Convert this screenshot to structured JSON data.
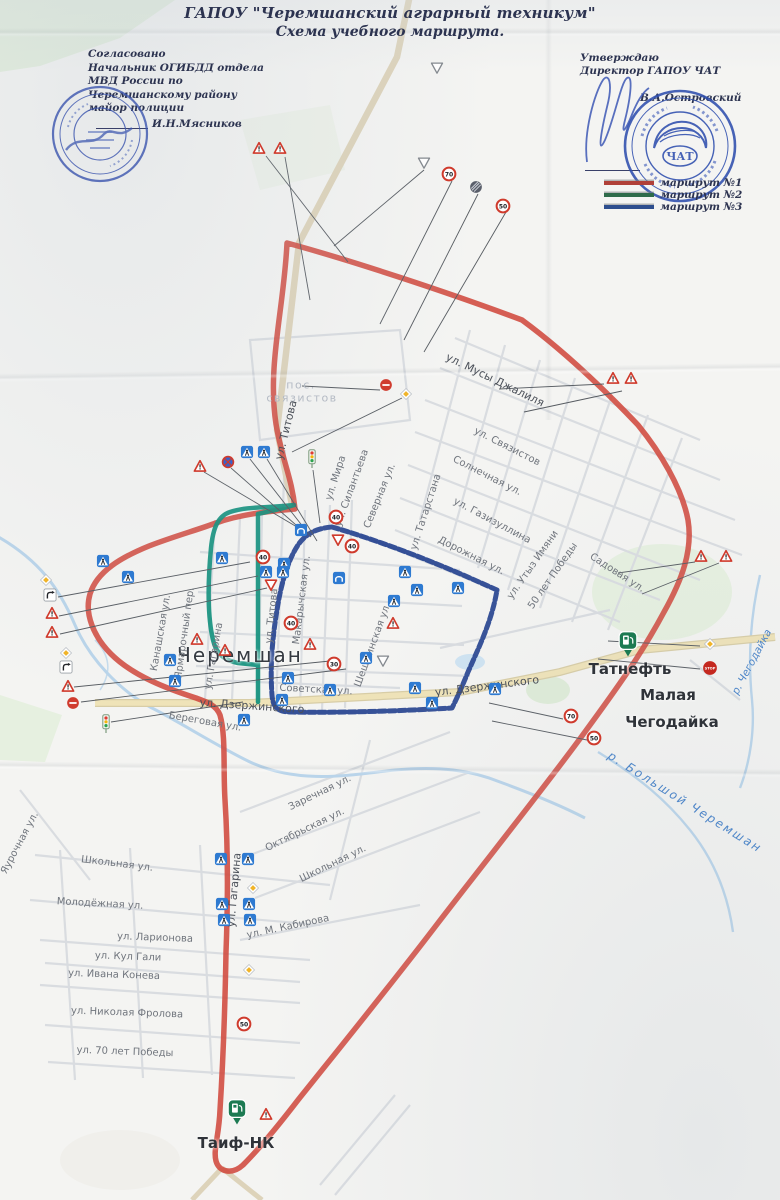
{
  "header": {
    "title_line1": "ГАПОУ \"Черемшанский аграрный техникум\"",
    "title_line2": "Схема учебного маршрута."
  },
  "approval_left": {
    "lines": "Согласовано\nНачальник ОГИБДД отдела\nМВД России по\nЧеремшанскому району\nмайор полиции",
    "name": "И.Н.Мясников"
  },
  "approval_right": {
    "line1": "Утверждаю",
    "line2": "Директор ГАПОУ ЧАТ",
    "name": "В.А.Островский",
    "stamp_center": "ЧАТ"
  },
  "legend": {
    "items": [
      {
        "label": "маршрут №1",
        "color": "#b04038"
      },
      {
        "label": "маршрут №2",
        "color": "#2e6b4a"
      },
      {
        "label": "маршрут №3",
        "color": "#2d4e8e"
      }
    ]
  },
  "map": {
    "route_colors": {
      "r1": "#d0493e",
      "r2": "#12917d",
      "r3": "#24418f"
    },
    "labels": [
      {
        "t": "пос.",
        "x": 301,
        "y": 385,
        "r": 0,
        "c": "l-lt"
      },
      {
        "t": "связистов",
        "x": 302,
        "y": 398,
        "r": 0,
        "c": "l-lt"
      },
      {
        "t": "ул. Мусы Джалиля",
        "x": 495,
        "y": 380,
        "r": 26,
        "c": "l-std"
      },
      {
        "t": "ул. Связистов",
        "x": 507,
        "y": 447,
        "r": 27,
        "c": "l-st"
      },
      {
        "t": "Солнечная ул.",
        "x": 487,
        "y": 476,
        "r": 27,
        "c": "l-st"
      },
      {
        "t": "ул. Мира",
        "x": 336,
        "y": 478,
        "r": -72,
        "c": "l-st"
      },
      {
        "t": "ул. Силантьева",
        "x": 352,
        "y": 488,
        "r": -70,
        "c": "l-st"
      },
      {
        "t": "Северная ул.",
        "x": 380,
        "y": 496,
        "r": -68,
        "c": "l-st"
      },
      {
        "t": "ул. Татарстана",
        "x": 426,
        "y": 512,
        "r": -72,
        "c": "l-st"
      },
      {
        "t": "ул. Газизуллина",
        "x": 492,
        "y": 521,
        "r": 28,
        "c": "l-st"
      },
      {
        "t": "Дорожная ул.",
        "x": 471,
        "y": 556,
        "r": 27,
        "c": "l-st"
      },
      {
        "t": "ул. Утыз Имяни",
        "x": 533,
        "y": 565,
        "r": -55,
        "c": "l-st"
      },
      {
        "t": "50 лет Победы",
        "x": 553,
        "y": 576,
        "r": -55,
        "c": "l-st"
      },
      {
        "t": "Садовая ул.",
        "x": 617,
        "y": 573,
        "r": 33,
        "c": "l-st"
      },
      {
        "t": "ул. Титова",
        "x": 286,
        "y": 430,
        "r": -76,
        "c": "l-std"
      },
      {
        "t": "ул. Титова",
        "x": 272,
        "y": 616,
        "r": -84,
        "c": "l-st"
      },
      {
        "t": "Черемшан",
        "x": 240,
        "y": 655,
        "r": 0,
        "c": "l-big"
      },
      {
        "t": "Советская ул.",
        "x": 316,
        "y": 690,
        "r": 3,
        "c": "l-st"
      },
      {
        "t": "ул. Дзержинского",
        "x": 252,
        "y": 706,
        "r": 4,
        "c": "l-std"
      },
      {
        "t": "ул. Дзержинского",
        "x": 487,
        "y": 686,
        "r": -7,
        "c": "l-std"
      },
      {
        "t": "Канашская ул.",
        "x": 161,
        "y": 633,
        "r": -80,
        "c": "l-st"
      },
      {
        "t": "Ярмарочный пер.",
        "x": 185,
        "y": 633,
        "r": -82,
        "c": "l-st"
      },
      {
        "t": "ул. Гагарина",
        "x": 214,
        "y": 656,
        "r": -80,
        "c": "l-st"
      },
      {
        "t": "Макарычская ул.",
        "x": 302,
        "y": 600,
        "r": -83,
        "c": "l-st"
      },
      {
        "t": "Шешминская ул.",
        "x": 373,
        "y": 645,
        "r": -70,
        "c": "l-st"
      },
      {
        "t": "Береговая ул.",
        "x": 205,
        "y": 722,
        "r": 10,
        "c": "l-st"
      },
      {
        "t": "Заречная ул.",
        "x": 320,
        "y": 793,
        "r": -26,
        "c": "l-st"
      },
      {
        "t": "Октябрьская ул.",
        "x": 305,
        "y": 830,
        "r": -26,
        "c": "l-st"
      },
      {
        "t": "Школьная ул.",
        "x": 333,
        "y": 864,
        "r": -26,
        "c": "l-st"
      },
      {
        "t": "Школьная ул.",
        "x": 117,
        "y": 864,
        "r": 7,
        "c": "l-st"
      },
      {
        "t": "Молодёжная ул.",
        "x": 100,
        "y": 904,
        "r": 3,
        "c": "l-st"
      },
      {
        "t": "ул. Ларионова",
        "x": 155,
        "y": 938,
        "r": 2,
        "c": "l-st"
      },
      {
        "t": "ул. Кул Гали",
        "x": 128,
        "y": 957,
        "r": 2,
        "c": "l-st"
      },
      {
        "t": "ул. Ивана Конева",
        "x": 114,
        "y": 975,
        "r": 2,
        "c": "l-st"
      },
      {
        "t": "ул. Николая Фролова",
        "x": 127,
        "y": 1013,
        "r": 2,
        "c": "l-st"
      },
      {
        "t": "ул. 70 лет Победы",
        "x": 125,
        "y": 1052,
        "r": 2,
        "c": "l-st"
      },
      {
        "t": "ул. М. Кабирова",
        "x": 288,
        "y": 927,
        "r": -12,
        "c": "l-st"
      },
      {
        "t": "ул. Гагарина",
        "x": 234,
        "y": 890,
        "r": -85,
        "c": "l-std"
      },
      {
        "t": "Яурочная ул.",
        "x": 20,
        "y": 843,
        "r": -62,
        "c": "l-st"
      },
      {
        "t": "Малая",
        "x": 668,
        "y": 695,
        "r": 0,
        "c": "l-town"
      },
      {
        "t": "Чегодайка",
        "x": 672,
        "y": 722,
        "r": 0,
        "c": "l-town"
      },
      {
        "t": "Татнефть",
        "x": 630,
        "y": 669,
        "r": 0,
        "c": "l-town"
      },
      {
        "t": "Таиф-НК",
        "x": 236,
        "y": 1143,
        "r": 0,
        "c": "l-town"
      },
      {
        "t": "р. Чегодайка",
        "x": 752,
        "y": 662,
        "r": -62,
        "c": "l-rv"
      },
      {
        "t": "р. Большой Черемшан",
        "x": 685,
        "y": 802,
        "r": 32,
        "c": "l-rvb"
      }
    ],
    "signs": [
      {
        "t": "warn",
        "x": 259,
        "y": 148
      },
      {
        "t": "warn",
        "x": 280,
        "y": 148
      },
      {
        "t": "giveo",
        "x": 437,
        "y": 68
      },
      {
        "t": "giveo",
        "x": 424,
        "y": 163
      },
      {
        "t": "spd",
        "x": 449,
        "y": 174,
        "v": "70"
      },
      {
        "t": "end",
        "x": 476,
        "y": 187
      },
      {
        "t": "spd",
        "x": 503,
        "y": 206,
        "v": "50"
      },
      {
        "t": "ne",
        "x": 386,
        "y": 385
      },
      {
        "t": "dia",
        "x": 406,
        "y": 394
      },
      {
        "t": "warn",
        "x": 613,
        "y": 378
      },
      {
        "t": "warn",
        "x": 631,
        "y": 378
      },
      {
        "t": "warn",
        "x": 701,
        "y": 556
      },
      {
        "t": "warn",
        "x": 726,
        "y": 556
      },
      {
        "t": "spd",
        "x": 571,
        "y": 716,
        "v": "70"
      },
      {
        "t": "spd",
        "x": 594,
        "y": 738,
        "v": "50"
      },
      {
        "t": "dia",
        "x": 710,
        "y": 644
      },
      {
        "t": "stop",
        "x": 710,
        "y": 668
      },
      {
        "t": "gas",
        "x": 628,
        "y": 644
      },
      {
        "t": "dia",
        "x": 46,
        "y": 580
      },
      {
        "t": "crv",
        "x": 50,
        "y": 595
      },
      {
        "t": "warn",
        "x": 52,
        "y": 613
      },
      {
        "t": "warn",
        "x": 52,
        "y": 632
      },
      {
        "t": "dia",
        "x": 66,
        "y": 653
      },
      {
        "t": "crv",
        "x": 66,
        "y": 667
      },
      {
        "t": "warn",
        "x": 68,
        "y": 686
      },
      {
        "t": "ne",
        "x": 73,
        "y": 703
      },
      {
        "t": "tl",
        "x": 106,
        "y": 724
      },
      {
        "t": "warn",
        "x": 200,
        "y": 466
      },
      {
        "t": "nsp",
        "x": 228,
        "y": 462
      },
      {
        "t": "ped",
        "x": 247,
        "y": 452
      },
      {
        "t": "ped",
        "x": 264,
        "y": 452
      },
      {
        "t": "tl",
        "x": 312,
        "y": 459
      },
      {
        "t": "ped",
        "x": 103,
        "y": 561
      },
      {
        "t": "ped",
        "x": 128,
        "y": 577
      },
      {
        "t": "ped",
        "x": 222,
        "y": 558
      },
      {
        "t": "ped",
        "x": 284,
        "y": 564
      },
      {
        "t": "spd",
        "x": 263,
        "y": 557,
        "v": "40"
      },
      {
        "t": "spd",
        "x": 336,
        "y": 517,
        "v": "40"
      },
      {
        "t": "spd",
        "x": 352,
        "y": 546,
        "v": "40"
      },
      {
        "t": "spd",
        "x": 291,
        "y": 623,
        "v": "40"
      },
      {
        "t": "spd",
        "x": 334,
        "y": 664,
        "v": "30"
      },
      {
        "t": "arch",
        "x": 301,
        "y": 530
      },
      {
        "t": "arch",
        "x": 339,
        "y": 578
      },
      {
        "t": "give",
        "x": 338,
        "y": 540
      },
      {
        "t": "give",
        "x": 271,
        "y": 585
      },
      {
        "t": "giveo",
        "x": 383,
        "y": 661
      },
      {
        "t": "ped",
        "x": 266,
        "y": 572
      },
      {
        "t": "ped",
        "x": 283,
        "y": 572
      },
      {
        "t": "ped",
        "x": 405,
        "y": 572
      },
      {
        "t": "ped",
        "x": 417,
        "y": 590
      },
      {
        "t": "ped",
        "x": 394,
        "y": 601
      },
      {
        "t": "ped",
        "x": 458,
        "y": 588
      },
      {
        "t": "warn",
        "x": 197,
        "y": 639
      },
      {
        "t": "warn",
        "x": 225,
        "y": 650
      },
      {
        "t": "warn",
        "x": 310,
        "y": 644
      },
      {
        "t": "warn",
        "x": 393,
        "y": 623
      },
      {
        "t": "ped",
        "x": 170,
        "y": 660
      },
      {
        "t": "ped",
        "x": 175,
        "y": 681
      },
      {
        "t": "ped",
        "x": 366,
        "y": 658
      },
      {
        "t": "ped",
        "x": 244,
        "y": 720
      },
      {
        "t": "ped",
        "x": 282,
        "y": 700
      },
      {
        "t": "ped",
        "x": 288,
        "y": 678
      },
      {
        "t": "ped",
        "x": 330,
        "y": 690
      },
      {
        "t": "ped",
        "x": 415,
        "y": 688
      },
      {
        "t": "ped",
        "x": 432,
        "y": 703
      },
      {
        "t": "ped",
        "x": 495,
        "y": 689
      },
      {
        "t": "ped",
        "x": 221,
        "y": 859
      },
      {
        "t": "ped",
        "x": 248,
        "y": 859
      },
      {
        "t": "ped",
        "x": 222,
        "y": 904
      },
      {
        "t": "ped",
        "x": 249,
        "y": 904
      },
      {
        "t": "ped",
        "x": 224,
        "y": 920
      },
      {
        "t": "ped",
        "x": 250,
        "y": 920
      },
      {
        "t": "dia",
        "x": 253,
        "y": 888
      },
      {
        "t": "dia",
        "x": 249,
        "y": 970
      },
      {
        "t": "spd",
        "x": 244,
        "y": 1024,
        "v": "50"
      },
      {
        "t": "gas",
        "x": 237,
        "y": 1112
      },
      {
        "t": "warn",
        "x": 266,
        "y": 1114
      }
    ],
    "leaders": [
      [
        266,
        156,
        348,
        262
      ],
      [
        285,
        157,
        310,
        300
      ],
      [
        424,
        170,
        334,
        246
      ],
      [
        452,
        181,
        380,
        324
      ],
      [
        478,
        194,
        404,
        340
      ],
      [
        506,
        212,
        424,
        352
      ],
      [
        604,
        384,
        499,
        389
      ],
      [
        622,
        391,
        524,
        412
      ],
      [
        695,
        562,
        618,
        573
      ],
      [
        719,
        563,
        642,
        594
      ],
      [
        563,
        719,
        489,
        703
      ],
      [
        587,
        740,
        492,
        721
      ],
      [
        700,
        646,
        608,
        641
      ],
      [
        700,
        669,
        598,
        659
      ],
      [
        380,
        390,
        302,
        386
      ],
      [
        402,
        398,
        292,
        452
      ],
      [
        58,
        597,
        250,
        562
      ],
      [
        59,
        616,
        258,
        576
      ],
      [
        60,
        634,
        267,
        588
      ],
      [
        74,
        687,
        330,
        661
      ],
      [
        81,
        702,
        346,
        669
      ],
      [
        111,
        722,
        243,
        702
      ],
      [
        204,
        472,
        297,
        527
      ],
      [
        231,
        468,
        304,
        532
      ],
      [
        250,
        459,
        311,
        537
      ],
      [
        267,
        459,
        317,
        541
      ],
      [
        313,
        470,
        320,
        523
      ]
    ]
  }
}
